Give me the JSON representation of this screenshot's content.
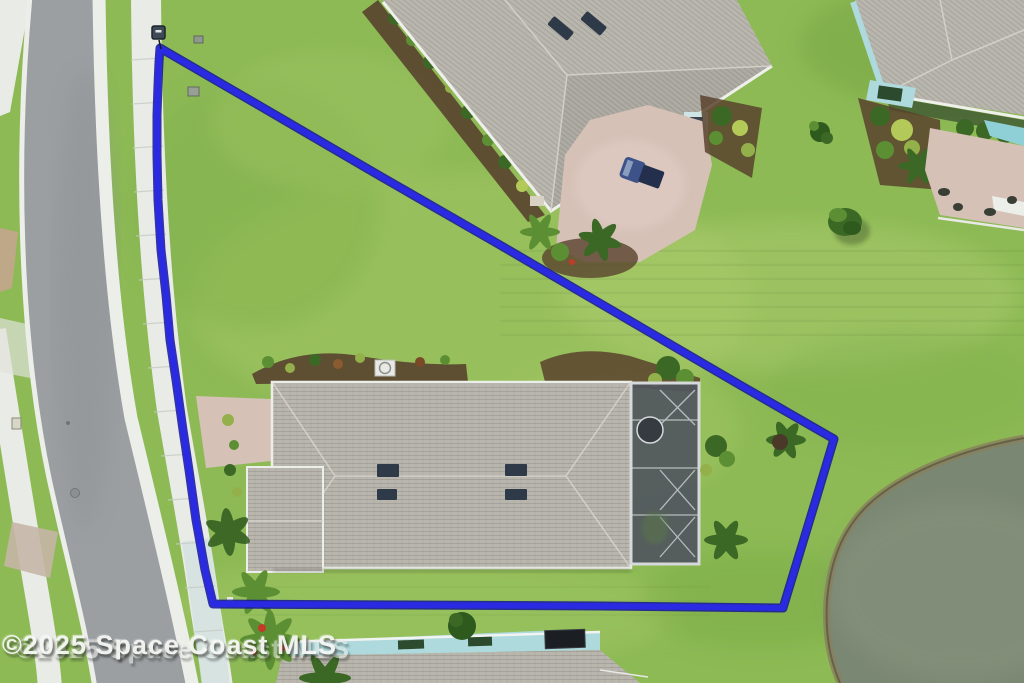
{
  "watermark": {
    "text": "©2025 Space Coast MLS"
  },
  "boundary": {
    "points": "160,48 260,106 380,176 500,245 620,315 740,385 834,439 817,496 800,552 783,608 600,606 400,605 213,604 205,570 196,520 189,470 183,430 176,380 170,340 166,295 161,250 158,200 157,155 157,115 158,85 159,62",
    "color_outer": "#141496",
    "color_inner": "#2a2ae2",
    "marker_color": "#3f4a56"
  },
  "colors": {
    "grass": "#8dba55",
    "road": "#9b9fa2",
    "sidewalk": "#e9ebe6",
    "sidewalk_cool": "#cfe0df",
    "curb": "#eceeea",
    "roof_shingle": "#b9b6ae",
    "roof_vent": "#2f3a49",
    "pool_cage": "#50565e",
    "cage_frame": "#d6d9db",
    "pond": "#7a8772",
    "pond_shore": "#8a7f5d",
    "paver": "#d6c1b7",
    "mulch": "#59422d",
    "teal_accent": "#aed9dd",
    "car_blue": "#3d5289",
    "solar_panel": "#1b1f24",
    "skylight_green": "#2c4a2e"
  }
}
